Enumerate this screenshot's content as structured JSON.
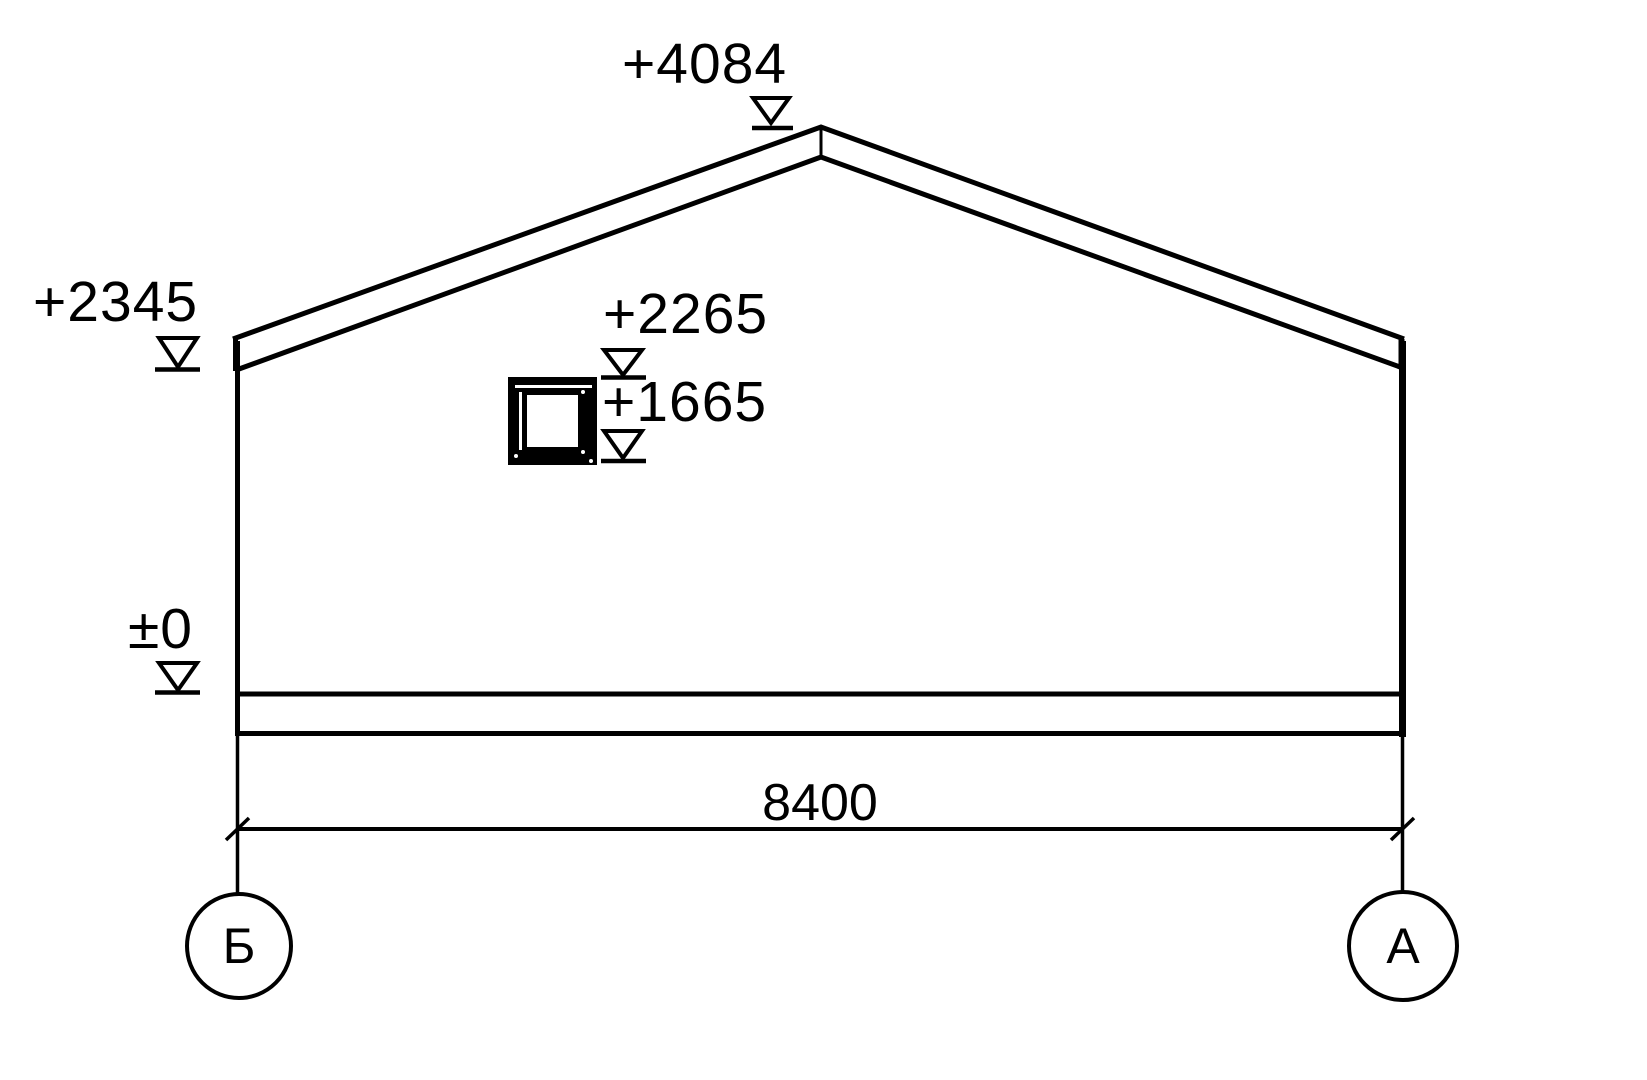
{
  "drawing": {
    "type": "building-elevation-section",
    "colors": {
      "line": "#000000",
      "background": "#ffffff",
      "opening_fill": "#000000"
    },
    "elevation_marks": [
      {
        "name": "roof-peak",
        "label": "+4084",
        "symbol": "elevation-mark-icon"
      },
      {
        "name": "eave",
        "label": "+2345",
        "symbol": "elevation-mark-icon"
      },
      {
        "name": "opening-top",
        "label": "+2265",
        "symbol": "elevation-mark-icon"
      },
      {
        "name": "opening-bottom",
        "label": "+1665",
        "symbol": "elevation-mark-icon"
      },
      {
        "name": "ground-level",
        "label": "±0",
        "symbol": "elevation-mark-icon"
      }
    ],
    "dimensions": [
      {
        "name": "overall-width",
        "label": "8400"
      }
    ],
    "axes": [
      {
        "name": "axis-b",
        "label": "Б"
      },
      {
        "name": "axis-a",
        "label": "А"
      }
    ]
  }
}
